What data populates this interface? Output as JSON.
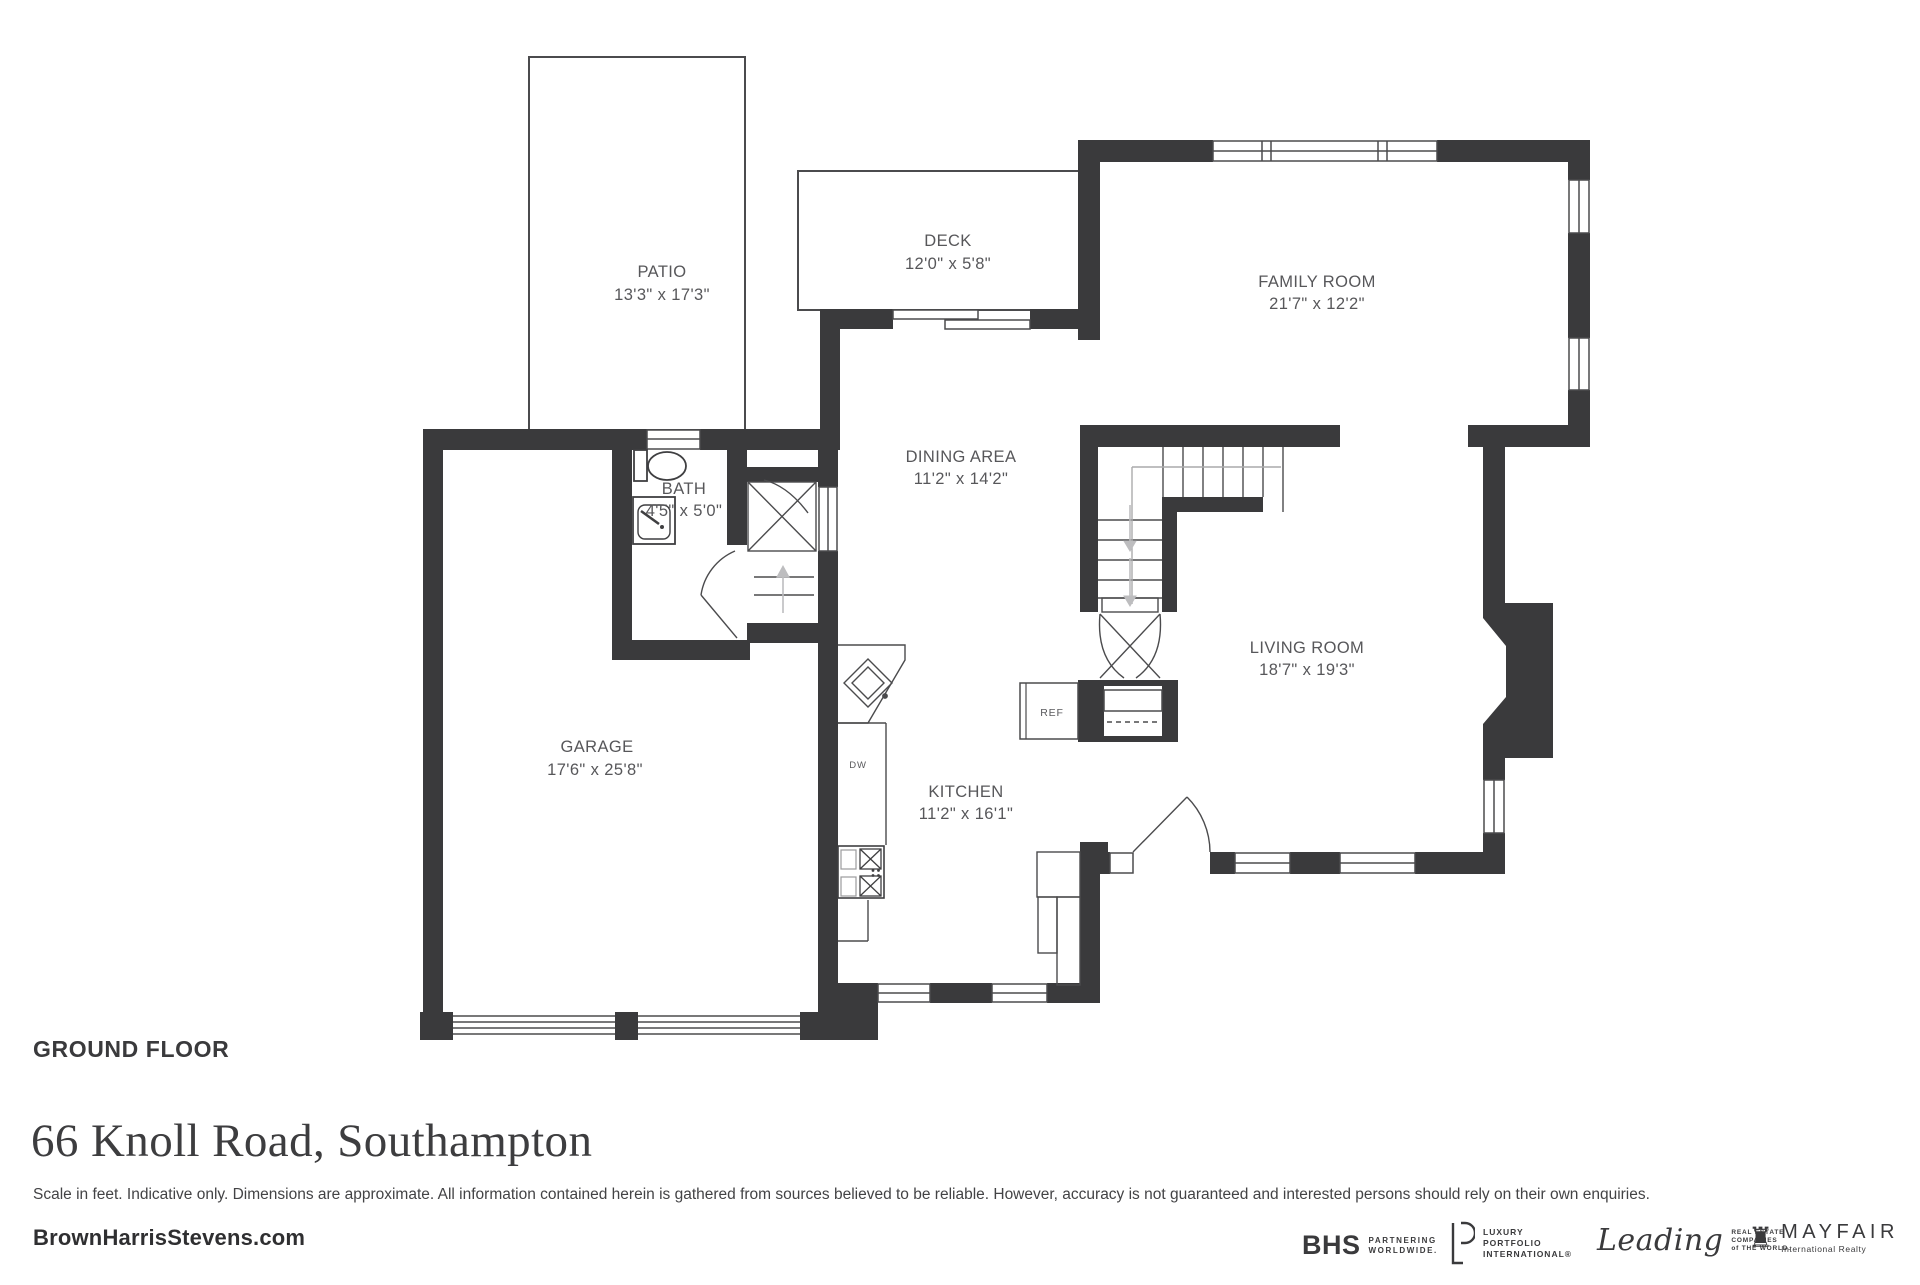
{
  "plan": {
    "rooms": {
      "patio": {
        "name": "PATIO",
        "dims": "13'3\" x 17'3\""
      },
      "deck": {
        "name": "DECK",
        "dims": "12'0\" x 5'8\""
      },
      "family": {
        "name": "FAMILY ROOM",
        "dims": "21'7\" x 12'2\""
      },
      "dining": {
        "name": "DINING AREA",
        "dims": "11'2\" x 14'2\""
      },
      "bath": {
        "name": "BATH",
        "dims": "4'5\" x 5'0\""
      },
      "garage": {
        "name": "GARAGE",
        "dims": "17'6\" x 25'8\""
      },
      "kitchen": {
        "name": "KITCHEN",
        "dims": "11'2\" x 16'1\""
      },
      "living": {
        "name": "LIVING ROOM",
        "dims": "18'7\" x 19'3\""
      }
    },
    "fixtures": {
      "ref": "REF",
      "dw": "DW"
    }
  },
  "footer": {
    "floor_label": "GROUND FLOOR",
    "address": "66 Knoll Road, Southampton",
    "disclaimer": "Scale in feet. Indicative only. Dimensions are approximate. All information contained herein is gathered from sources believed to be reliable. However, accuracy is not guaranteed and interested persons should rely on their own enquiries.",
    "website": "BrownHarrisStevens.com"
  },
  "logos": {
    "bhs": {
      "name": "BHS",
      "tagline1": "PARTNERING",
      "tagline2": "WORLDWIDE."
    },
    "lpi": {
      "line1": "LUXURY",
      "line2": "PORTFOLIO",
      "line3": "INTERNATIONAL®"
    },
    "leading": {
      "script": "Leading",
      "line1": "REAL ESTATE",
      "line2": "COMPANIES",
      "line3": "of THE WORLD."
    },
    "mayfair": {
      "rook": "♜",
      "name": "MAYFAIR",
      "tagline": "International Realty"
    }
  },
  "colors": {
    "wall": "#3a3a3c",
    "line": "#4b4b4d",
    "label": "#57575a",
    "arrow": "#bdbdbf"
  }
}
